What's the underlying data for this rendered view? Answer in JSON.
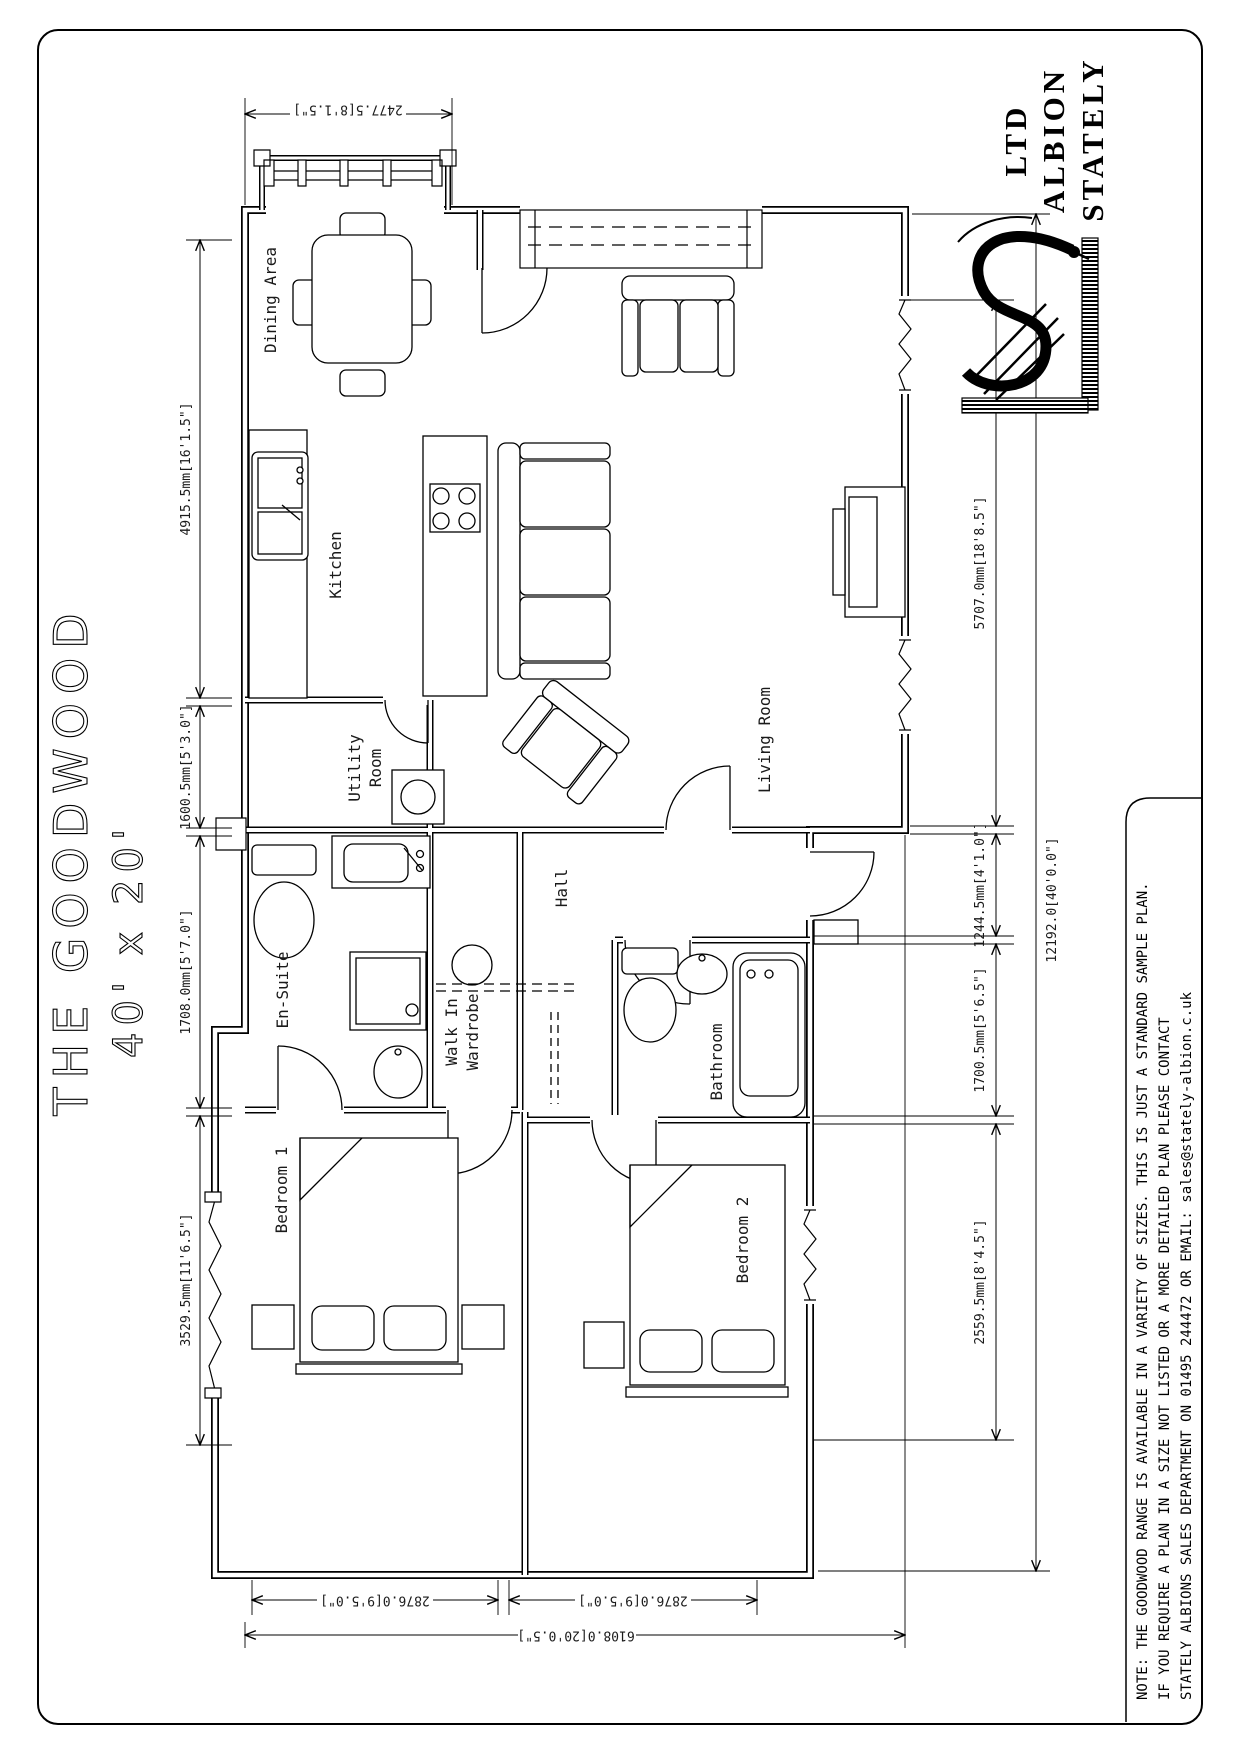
{
  "title": {
    "line1": "THE GOODWOOD",
    "line2": "40' x 20'"
  },
  "company": {
    "word1": "STATELY",
    "word2": "ALBION",
    "word3": "LTD"
  },
  "logo": {
    "name": "stately-albion-monogram"
  },
  "note": {
    "line1": "NOTE: THE GOODWOOD RANGE IS AVAILABLE IN A VARIETY OF SIZES. THIS IS JUST A STANDARD SAMPLE PLAN.",
    "line2": "IF YOU REQUIRE A PLAN IN A SIZE NOT LISTED OR A MORE DETAILED PLAN PLEASE CONTACT",
    "line3": "STATELY ALBIONS SALES DEPARTMENT ON 01495 244472 OR EMAIL: sales@stately-albion.c.uk"
  },
  "rooms": {
    "dining": "Dining Area",
    "kitchen": "Kitchen",
    "utility1": "Utility",
    "utility2": "Room",
    "living": "Living Room",
    "ensuite": "En-Suite",
    "hall": "Hall",
    "wardrobe1": "Walk In",
    "wardrobe2": "Wardrobe",
    "bedroom1": "Bedroom 1",
    "bathroom": "Bathroom",
    "bedroom2": "Bedroom 2"
  },
  "dims": {
    "top": "2477.5[8'1.5\"]",
    "left": [
      "4915.5mm[16'1.5\"]",
      "1600.5mm[5'3.0\"]",
      "1708.0mm[5'7.0\"]",
      "3529.5mm[11'6.5\"]"
    ],
    "right": [
      "5707.0mm[18'8.5\"]",
      "1244.5mm[4'1.0\"]",
      "1700.5mm[5'6.5\"]",
      "2559.5mm[8'4.5\"]"
    ],
    "overall_height": "12192.0[40'0.0\"]",
    "bottom": [
      "2876.0[9'5.0\"]",
      "2876.0[9'5.0\"]"
    ],
    "overall_width": "6108.0[20'0.5\"]"
  },
  "colors": {
    "ink": "#000000",
    "paper": "#ffffff"
  }
}
